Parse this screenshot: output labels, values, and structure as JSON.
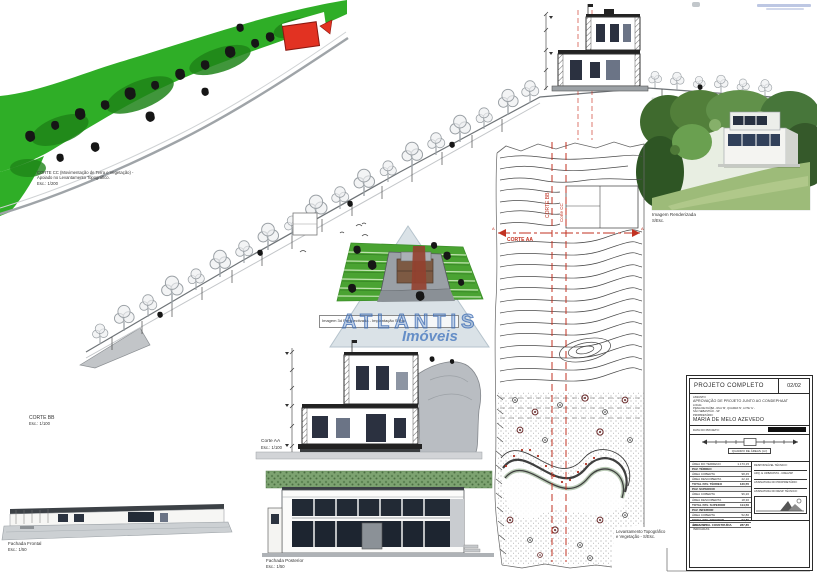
{
  "sheet": {
    "watermark_brand": "ATLANTIS",
    "watermark_sub": "Imóveis"
  },
  "labels": {
    "corte_cc": {
      "line1": "CORTE CC (Movimentação de Terra e Vegetação) -",
      "line2": "Apoiado no Levantamento Topográfico.",
      "esc": "Esc.: 1/200"
    },
    "corte_bb": {
      "name": "CORTE BB",
      "esc": "Esc.: 1/100"
    },
    "corte_aa": {
      "name": "Corte AA",
      "esc": "Esc.: 1/100"
    },
    "fachada_frontal": {
      "name": "Fachada Frontal",
      "esc": "Esc.: 1/50"
    },
    "fachada_posterior": {
      "name": "Fachada Posterior",
      "esc": "Esc.: 1/50"
    },
    "imagem_renderizada": {
      "name": "Imagem Renderizada",
      "esc": "S/Esc."
    },
    "imagem_3d": "Imagem 3d Perspectivada - Implantação S/Esc.",
    "levantamento": {
      "line1": "Levantamento Topográfico",
      "line2": "e Vegetação - S/Esc."
    }
  },
  "plan": {
    "corte_bb_line": "CORTE BB",
    "corte_cc_line": "Corte CC",
    "corte_aa_line": "CORTE AA",
    "section_arrow": "A"
  },
  "title_block": {
    "title": "PROJETO COMPLETO",
    "sheet_no": "02/02",
    "assunto_label": "ASSUNTO:",
    "assunto": "APROVAÇÃO DE PROJETO JUNTO AO CONDEPHAAT",
    "local_label": "LOCAL:",
    "local1": "PRAIA DE PAÚBA - RUA 'M', QUADRA 'N', LOTE 'G' -",
    "local2": "SÃO SEBASTIÃO - SP",
    "prop_label": "PROPRIETÁRIO:",
    "proprietario": "MARIA DE MELO AZEVEDO",
    "data_label": "DATA DO PROJETO:",
    "areas_header": "QUADRO DE ÁREAS (m²)",
    "rows": [
      {
        "l": "ÁREA DO TERRENO",
        "v": "1.173,15"
      },
      {
        "l": "PAV. TÉRREO",
        "v": ""
      },
      {
        "l": "ÁREA COBERTA",
        "v": "98,45"
      },
      {
        "l": "ÁREA DESCOBERTA",
        "v": "22,10"
      },
      {
        "l": "TOTAL PAV. TÉRREO",
        "v": "120,55"
      },
      {
        "l": "PAV. SUPERIOR",
        "v": ""
      },
      {
        "l": "ÁREA COBERTA",
        "v": "96,20"
      },
      {
        "l": "ÁREA DESCOBERTA",
        "v": "18,30"
      },
      {
        "l": "TOTAL PAV. SUPERIOR",
        "v": "114,50"
      },
      {
        "l": "PAV. INFERIOR",
        "v": ""
      },
      {
        "l": "ÁREA COBERTA",
        "v": "52,80"
      },
      {
        "l": "TOTAL PAV. INFERIOR",
        "v": "52,80"
      },
      {
        "l": "ÁREA TOTAL CONSTRUÍDA",
        "v": "287,85"
      }
    ],
    "sig1a": "RESPONSÁVEL TÉCNICO:",
    "sig1b": "ARQ. E URBANISTA - CREA/SP",
    "sig2a": "ASSINATURA DO PROPRIETÁRIO:",
    "sig2b": "ASSINATURA DO RESP. TÉCNICO:",
    "escalas_label": "ESCALAS:",
    "escalas_value": "INDICADAS"
  }
}
